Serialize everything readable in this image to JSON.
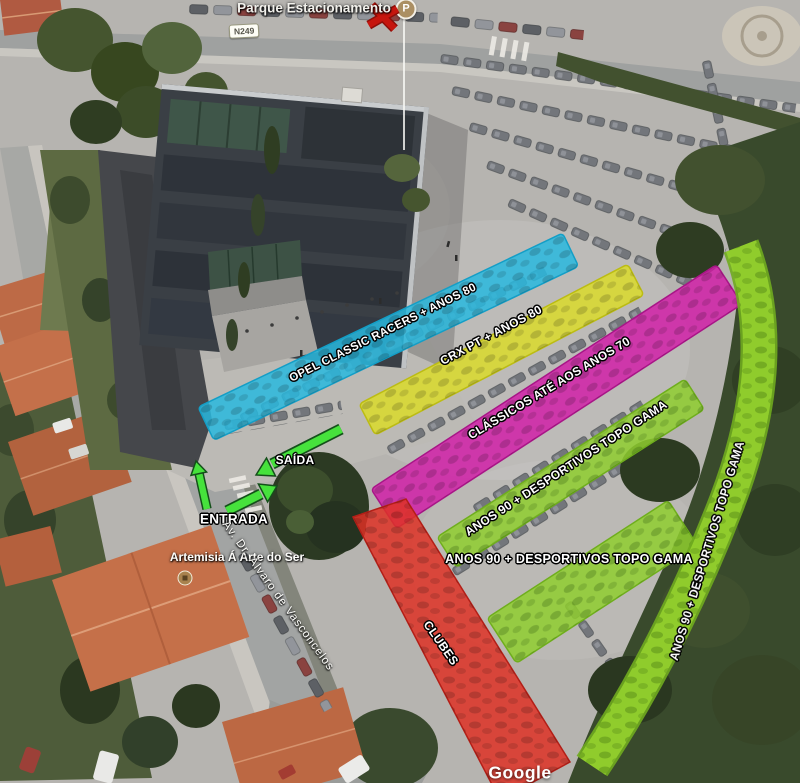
{
  "map": {
    "top_label": "Parque Estacionamento",
    "road_badge": "N249",
    "marker_letter": "P",
    "poi_label": "Artemisia Á Arte do Ser",
    "street_label": "Av. Dr. Álvaro de Vasconcelos",
    "attribution": "Google"
  },
  "zones": [
    {
      "id": "opel",
      "label": "OPEL CLASSIC RACERS + ANOS 80",
      "color": "#29b8de"
    },
    {
      "id": "crx",
      "label": "CRX PT + ANOS 80",
      "color": "#dbdb2a"
    },
    {
      "id": "classicos",
      "label": "CLÁSSICOS ATÉ AOS ANOS 70",
      "color": "#d024a8"
    },
    {
      "id": "anos90-row-1",
      "label": "ANOS 90 + DESPORTIVOS TOPO GAMA",
      "color": "#8fce2f"
    },
    {
      "id": "anos90-row-2",
      "label": "ANOS 90 + DESPORTIVOS TOPO GAMA",
      "color": "#8fce2f"
    },
    {
      "id": "anos90-curve",
      "label": "ANOS 90 + DESPORTIVOS TOPO GAMA",
      "color": "#97d32f"
    },
    {
      "id": "clubes",
      "label": "CLUBES",
      "color": "#de3126"
    }
  ],
  "arrows": {
    "exit_label": "SAÍDA",
    "entrance_label": "ENTRADA",
    "arrow_color": "#46e23c"
  }
}
